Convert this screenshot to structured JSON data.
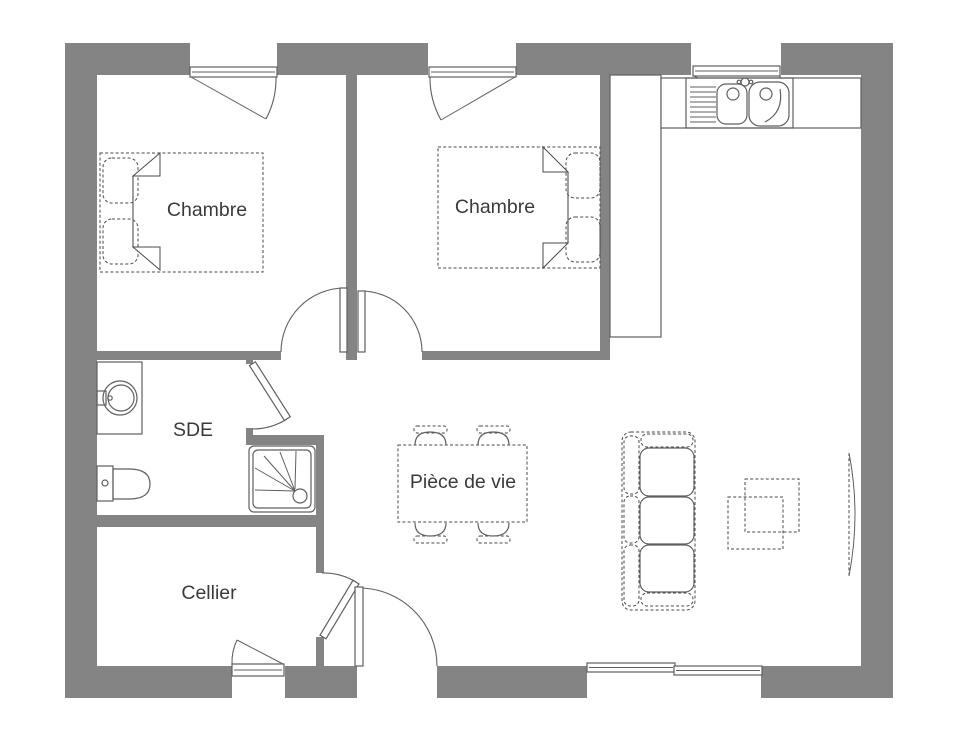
{
  "colors": {
    "background": "#ffffff",
    "wall": "#848484",
    "outline": "#5f5f5f",
    "furniture": "#4a4a4a",
    "text": "#3a3a3a"
  },
  "rooms": {
    "bedroom1": {
      "label": "Chambre"
    },
    "bedroom2": {
      "label": "Chambre"
    },
    "shower_room": {
      "label": "SDE"
    },
    "cellar": {
      "label": "Cellier"
    },
    "living_room": {
      "label": "Pièce de vie"
    }
  },
  "fixtures": [
    "double-bed",
    "nightstand",
    "casement-window",
    "sliding-bay-window",
    "interior-door",
    "entrance-door",
    "kitchen-counter",
    "kitchen-sink",
    "drainboard",
    "faucet",
    "washbasin",
    "toilet",
    "shower-tray",
    "dining-table",
    "dining-chair",
    "sofa",
    "coffee-table",
    "tv"
  ]
}
